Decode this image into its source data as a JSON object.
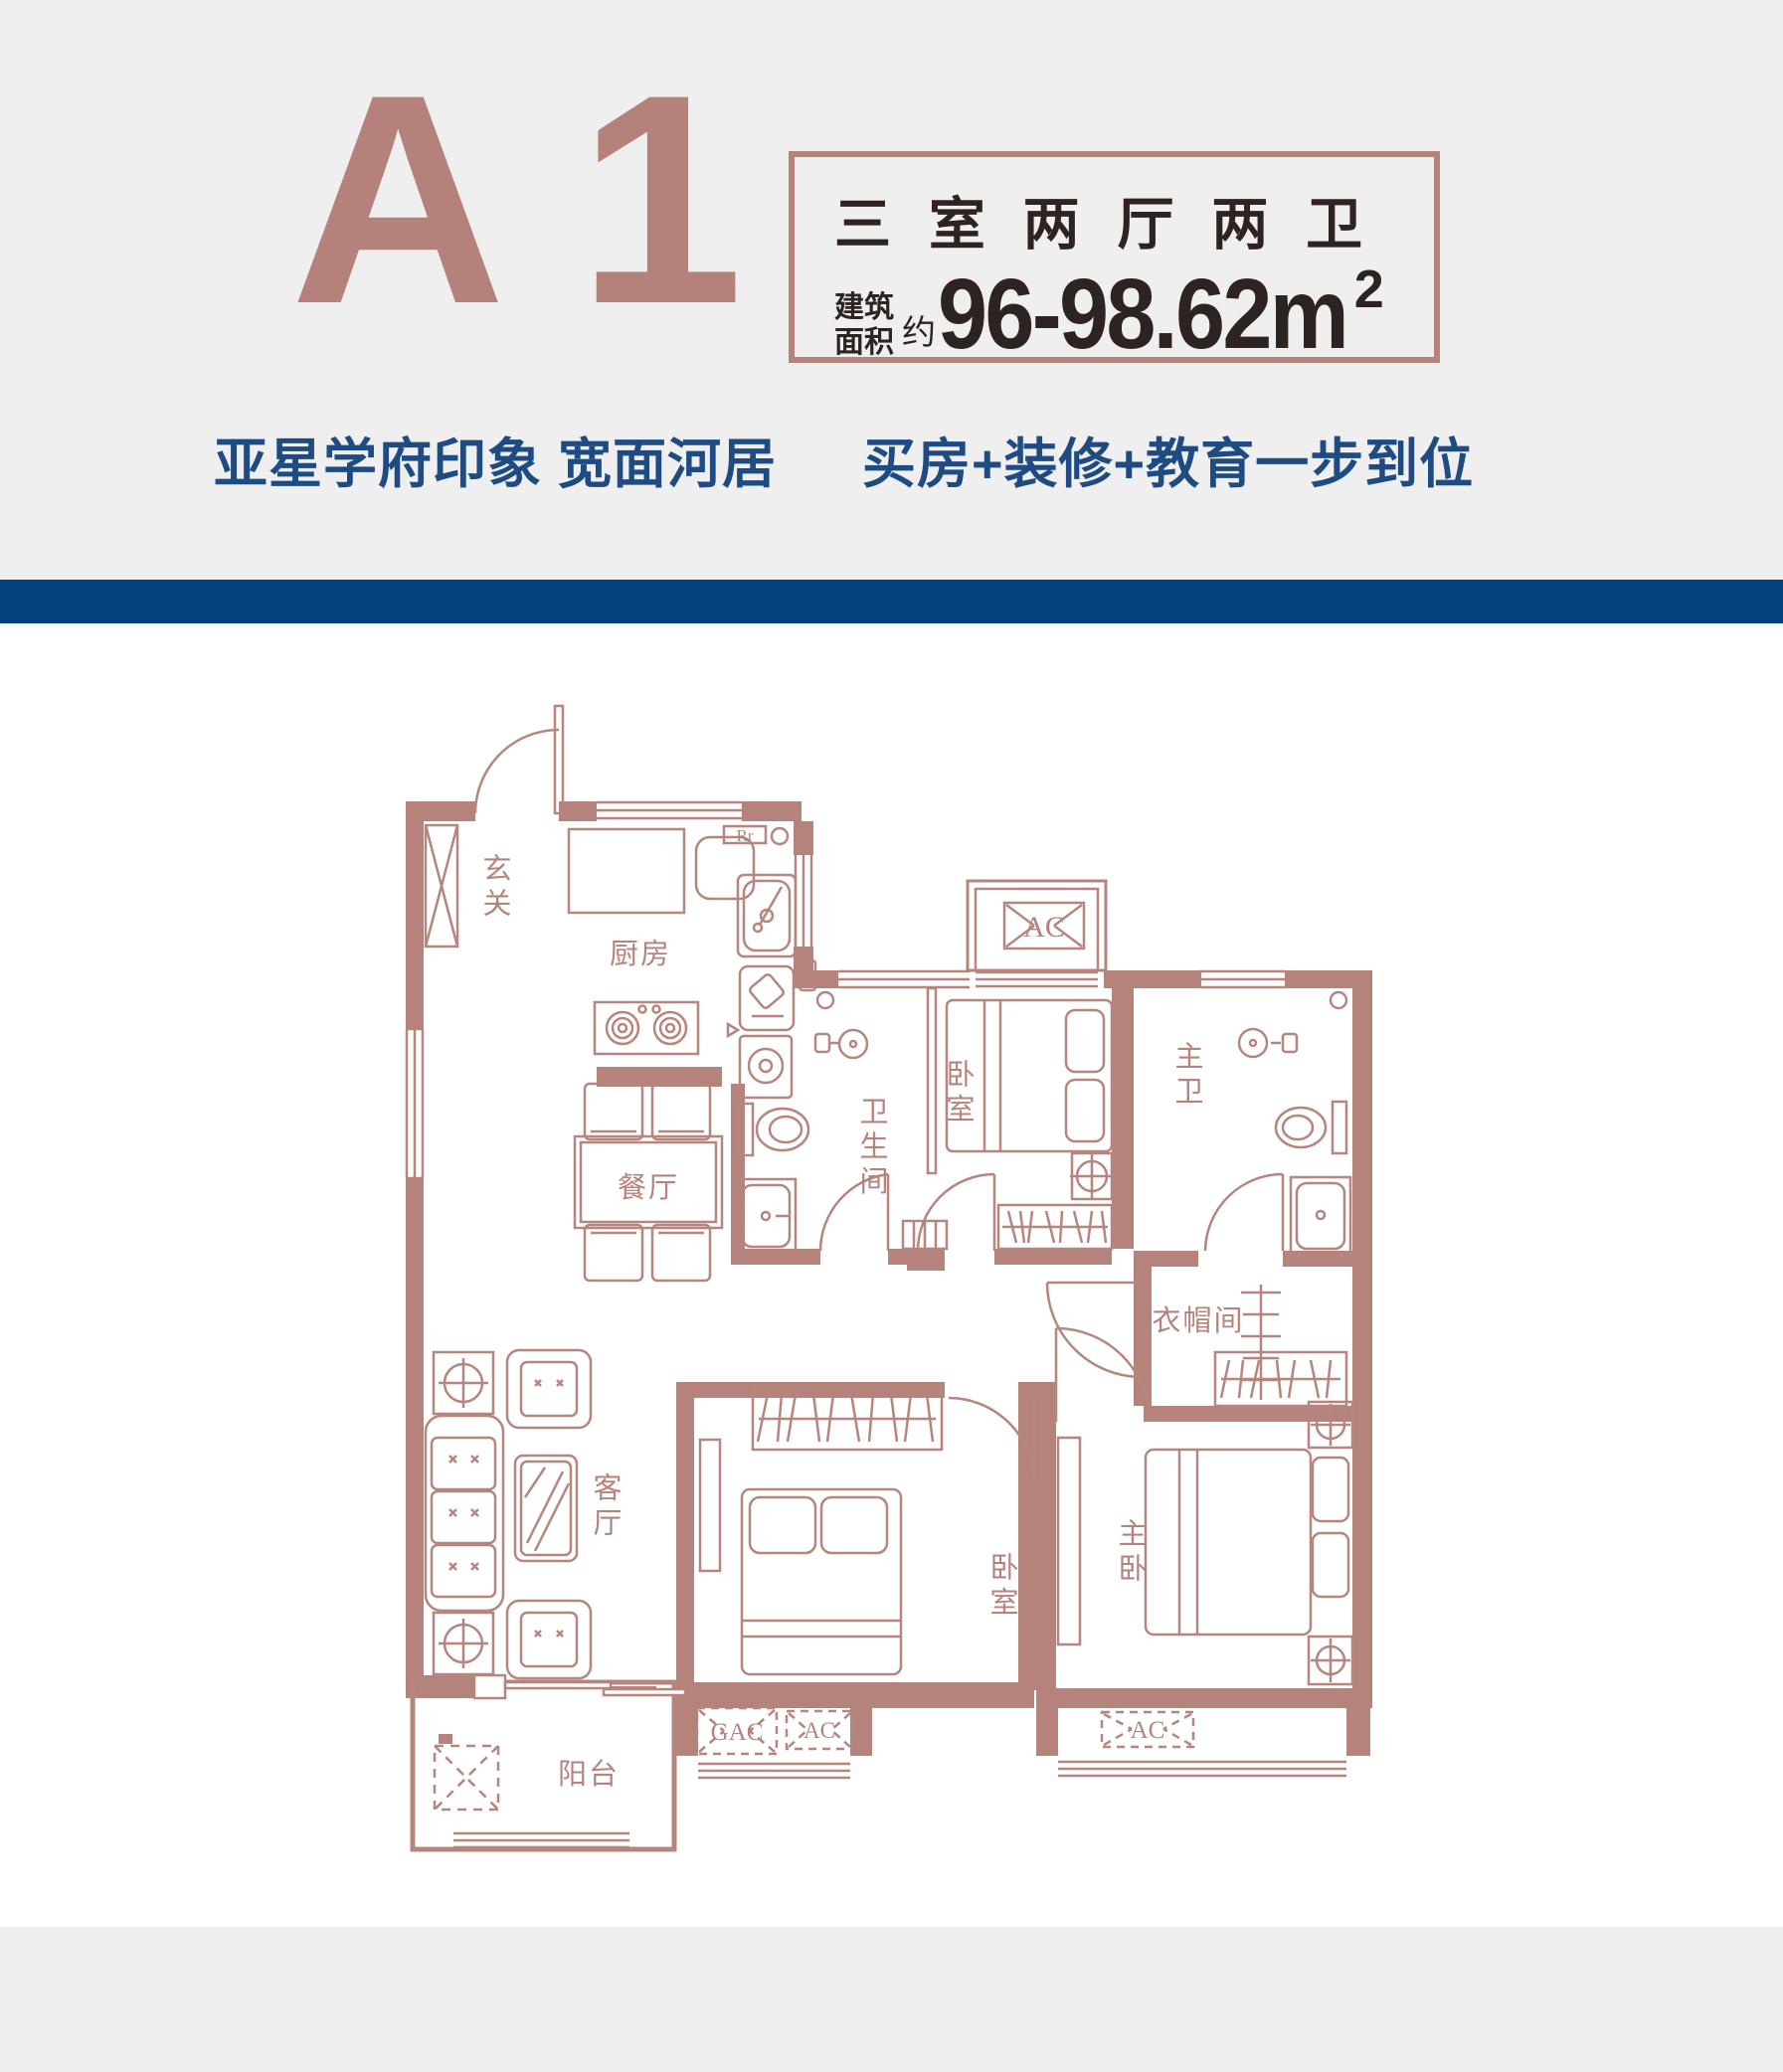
{
  "header": {
    "unit_label": "A 1",
    "spec_box": {
      "room_type": "三 室 两 厅 两 卫",
      "area_label_line1": "建筑",
      "area_label_line2": "面积",
      "area_approx": "约",
      "area_value": "96-98.62m",
      "area_unit_sup": "2"
    },
    "tagline": {
      "left": "亚星学府印象 宽面河居",
      "right": "买房+装修+教育一步到位"
    }
  },
  "colors": {
    "rose_accent": "#b5837c",
    "dark_text": "#2d2421",
    "blue_bar": "#04407c",
    "blue_text": "#1d4b82",
    "page_bg": "#efeff0",
    "plan_bg": "#ffffff"
  },
  "floor_plan": {
    "rooms": {
      "entry": "玄关",
      "kitchen": "厨房",
      "dining": "餐厅",
      "bathroom": "卫生间",
      "bedroom_top": "卧室",
      "master_bath": "主卫",
      "closet": "衣帽间",
      "living": "客厅",
      "bedroom_bottom": "卧室",
      "master_bedroom": "主卧",
      "balcony": "阳台"
    },
    "equipment": {
      "ac_top": "AC",
      "gac_bottom": "GAC",
      "ac_bottom_mid": "AC",
      "ac_bottom_right": "AC",
      "fridge": "Rr"
    }
  }
}
